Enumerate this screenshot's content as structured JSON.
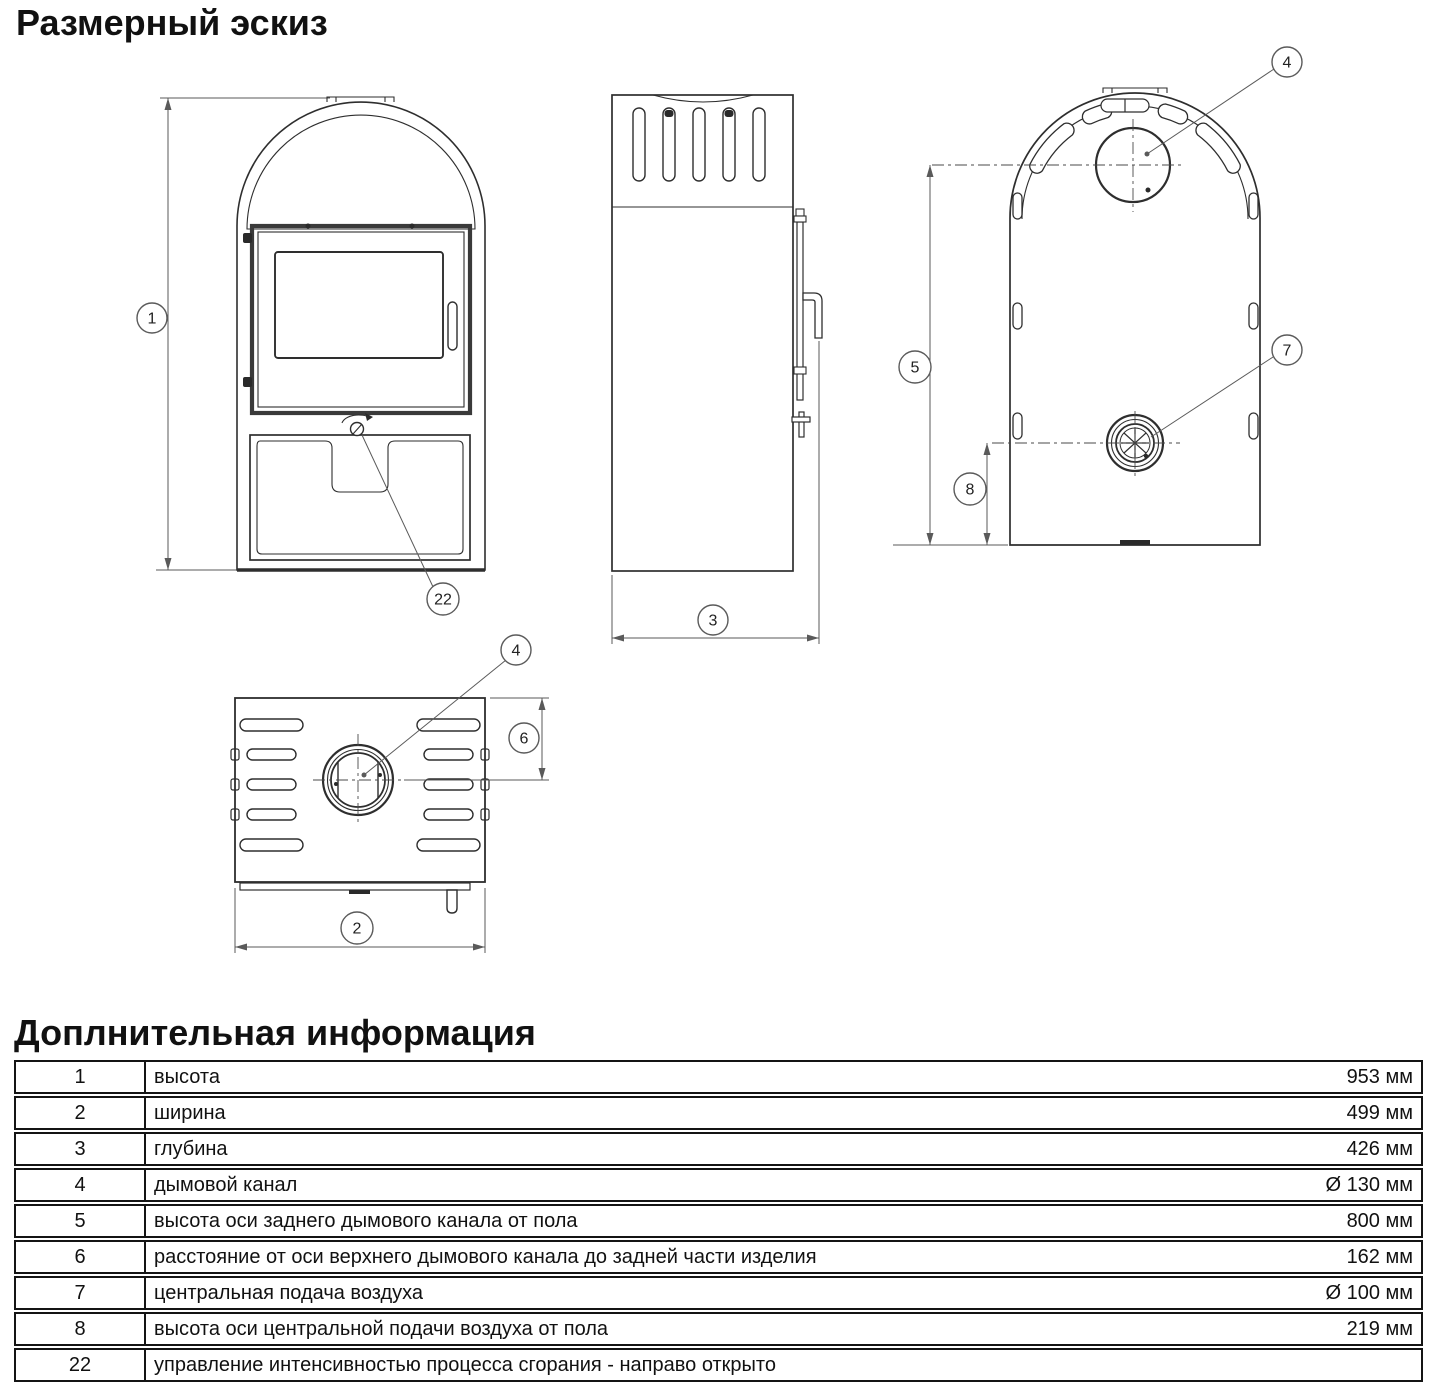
{
  "page": {
    "title": "Размерный эскиз",
    "info_title": "Доплнительная информация"
  },
  "colors": {
    "background": "#ffffff",
    "drawing_line": "#2e2e2e",
    "dimension_line": "#5a5a5a",
    "table_border": "#141414"
  },
  "drawing": {
    "views": [
      "front",
      "side",
      "back",
      "top"
    ],
    "balloons": {
      "height": "1",
      "width": "2",
      "depth": "3",
      "flue": "4",
      "rear_flue_height": "5",
      "flue_axis_offset": "6",
      "air_supply": "7",
      "air_height": "8",
      "combustion_control": "22"
    }
  },
  "table": {
    "rows": [
      {
        "num": "1",
        "label": "высота",
        "value": "953 мм"
      },
      {
        "num": "2",
        "label": "ширина",
        "value": "499 мм"
      },
      {
        "num": "3",
        "label": "глубина",
        "value": "426 мм"
      },
      {
        "num": "4",
        "label": "дымовой канал",
        "value": "Ø 130 мм"
      },
      {
        "num": "5",
        "label": "высота оси заднего дымового канала от пола",
        "value": "800 мм"
      },
      {
        "num": "6",
        "label": "расстояние от оси верхнего дымового канала до задней части изделия",
        "value": "162 мм"
      },
      {
        "num": "7",
        "label": "центральная подача воздуха",
        "value": "Ø 100 мм"
      },
      {
        "num": "8",
        "label": "высота оси центральной подачи воздуха от пола",
        "value": "219 мм"
      },
      {
        "num": "22",
        "label": "управление интенсивностью процесса сгорания - направо открыто",
        "value": ""
      }
    ]
  }
}
